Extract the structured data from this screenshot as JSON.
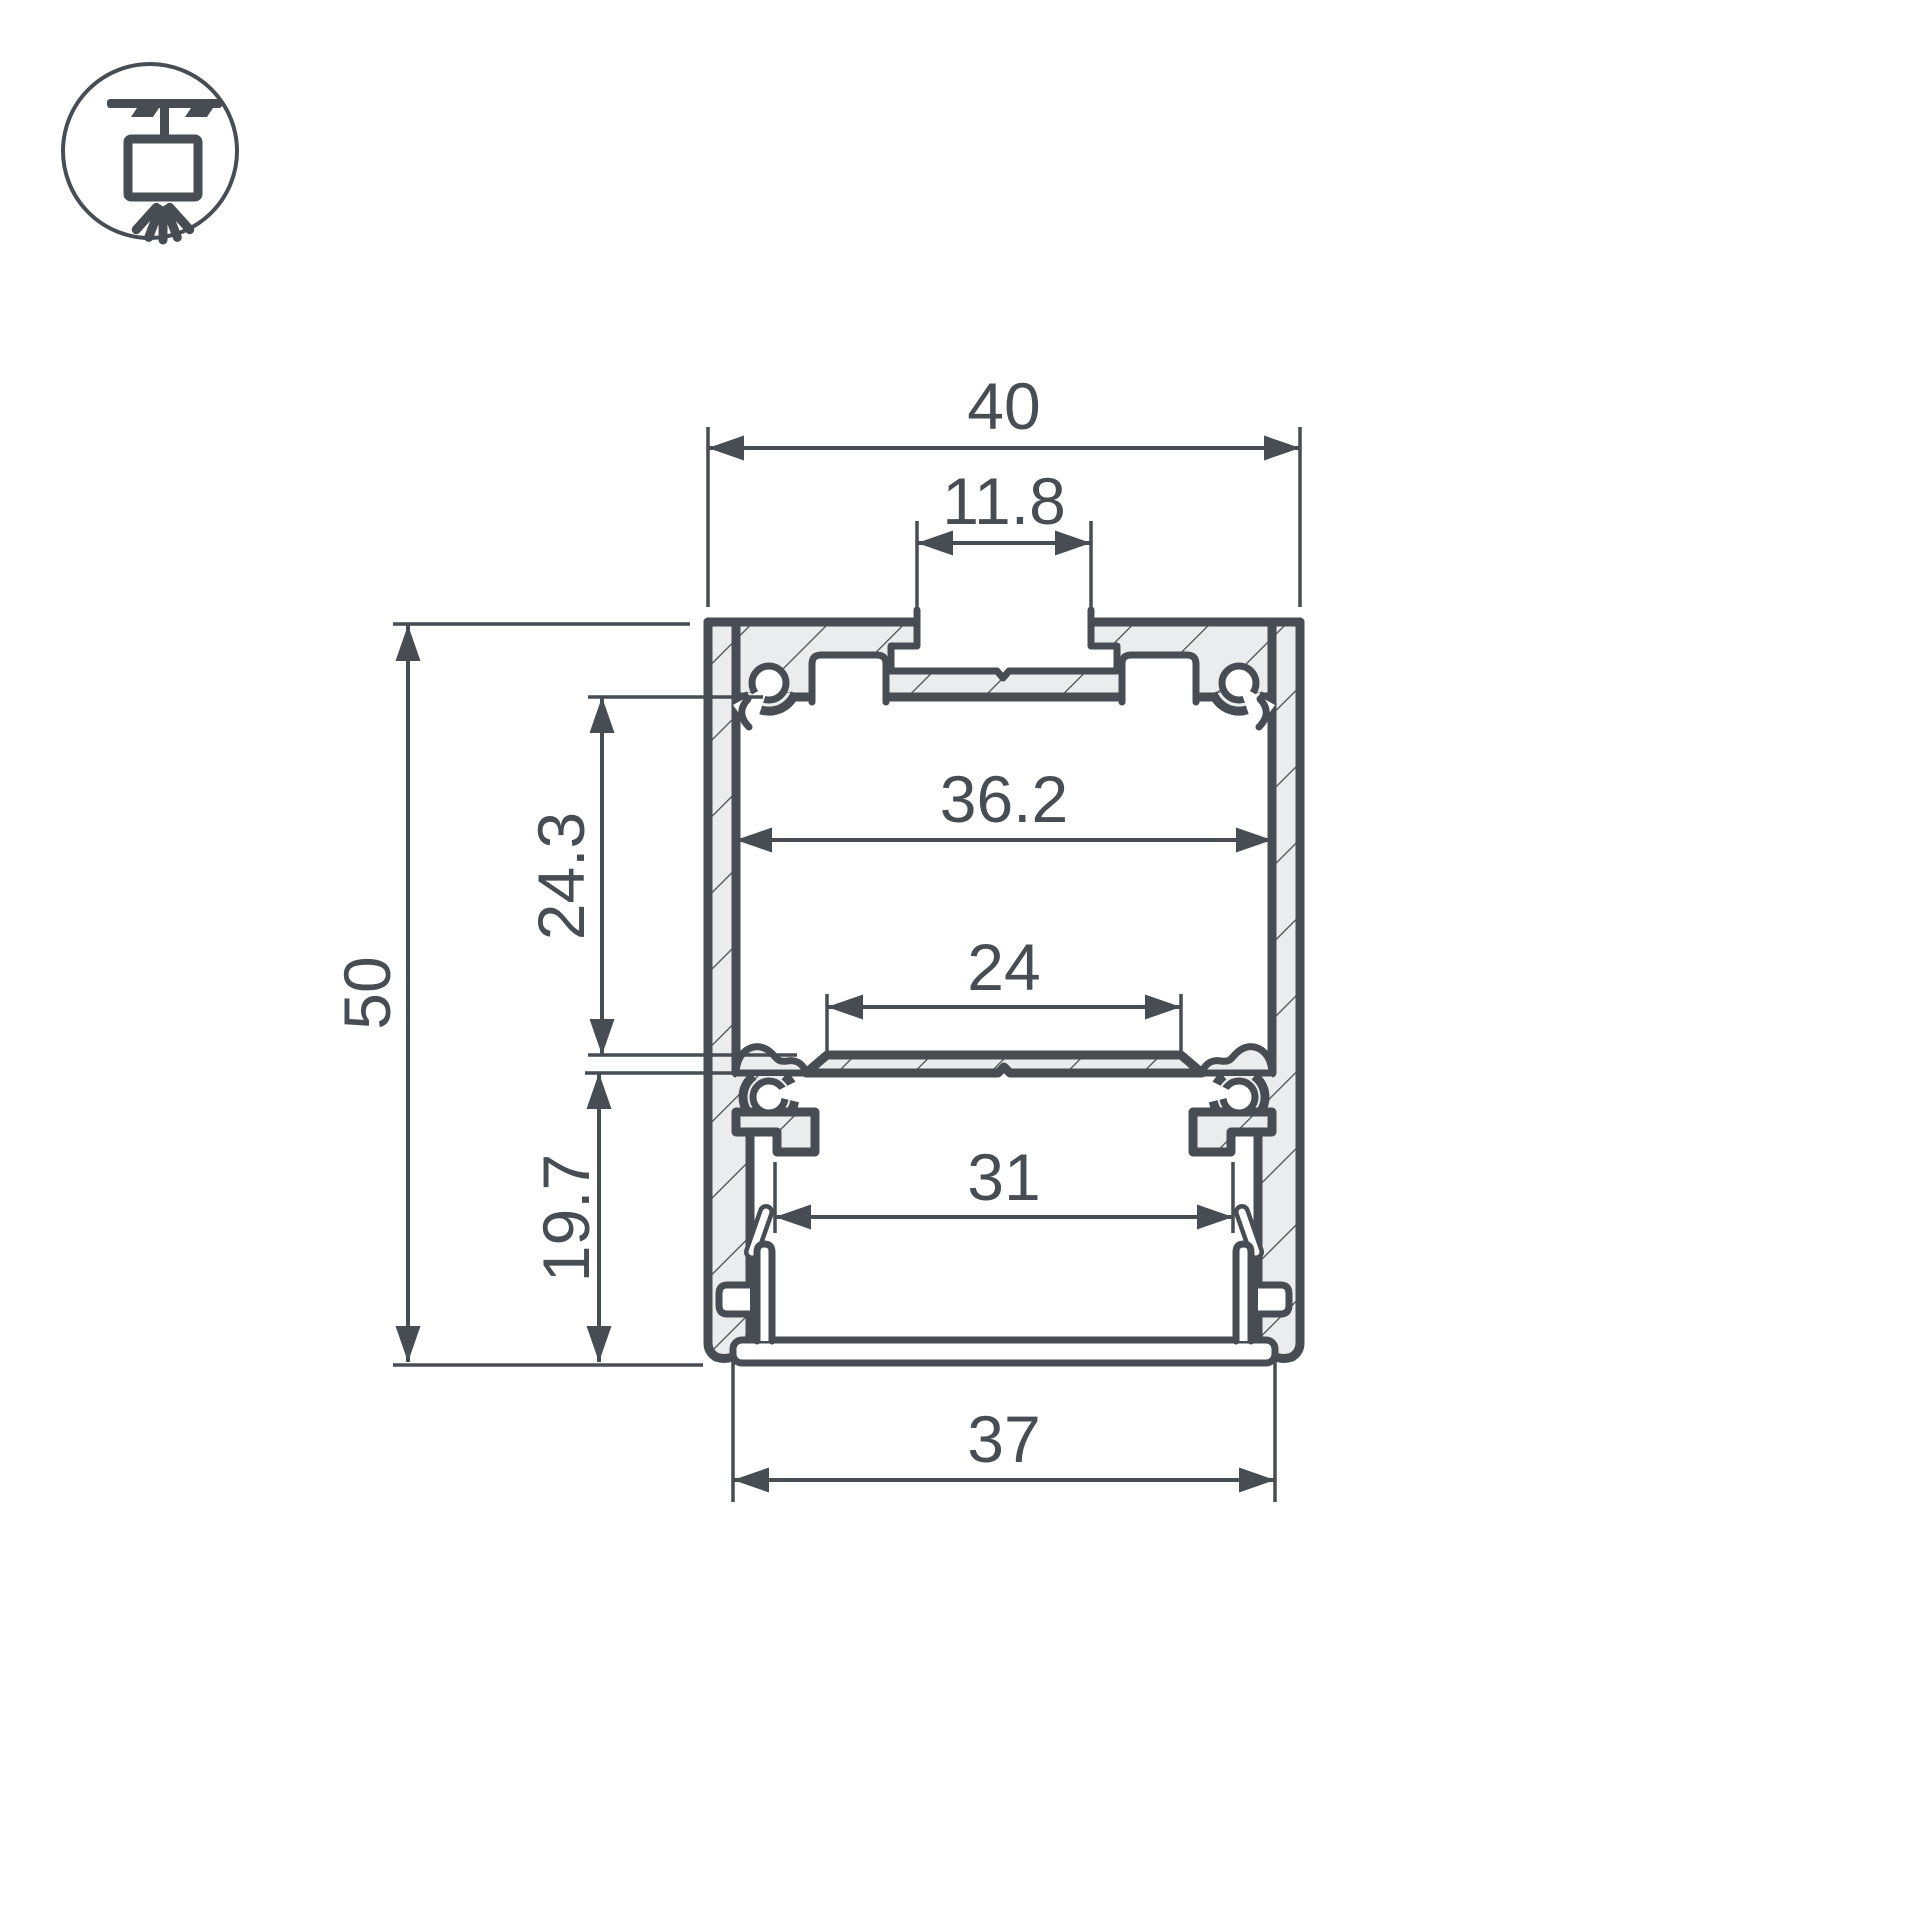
{
  "meta": {
    "background_color": "#ffffff",
    "line_color": "#474d53",
    "material_fill_color": "#ebeced",
    "drawing_kind": "led-profile-cross-section"
  },
  "mount_icon": {
    "name": "pendant-ceiling-mount-icon"
  },
  "dimensions": {
    "overall_width": "40",
    "top_slot_width": "11.8",
    "inner_width": "36.2",
    "upper_cavity_depth": "24.3",
    "overall_height": "50",
    "led_platform_width": "24",
    "lower_opening_width": "31",
    "lower_cavity_depth": "19.7",
    "bottom_width": "37"
  }
}
